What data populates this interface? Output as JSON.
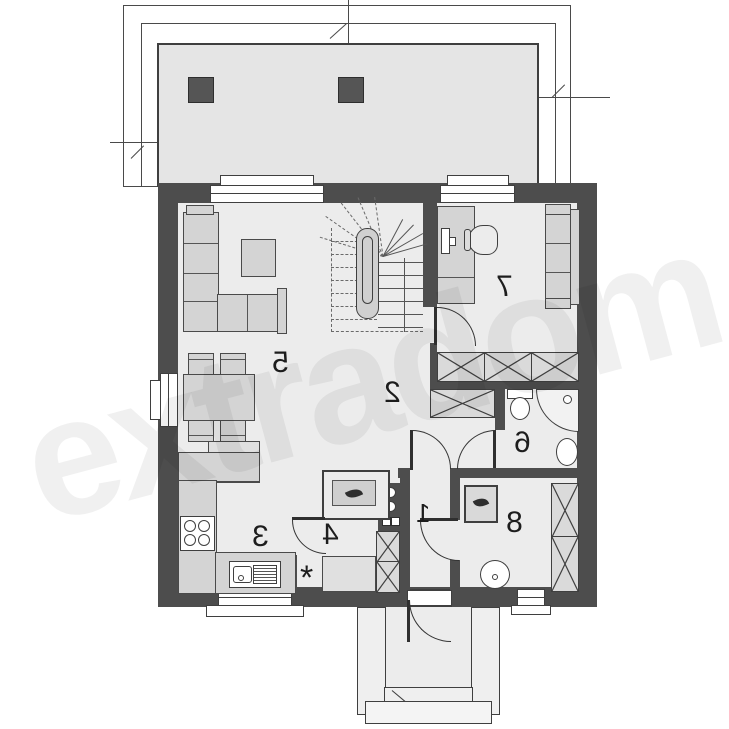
{
  "watermark": {
    "text": "extradom"
  },
  "rooms": {
    "r1": "1",
    "r2": "2",
    "r3": "3",
    "r4": "4",
    "r5": "5",
    "r6": "6",
    "r7": "7",
    "r8": "8"
  },
  "symbols": {
    "asterisk": "*"
  },
  "colors": {
    "wall": "#4d4d4d",
    "floor": "#ececec",
    "terrace": "#e5e5e5",
    "furniture": "#d4d4d4",
    "line": "#3f3f3f",
    "watermark": "rgba(0,0,0,0.06)"
  }
}
